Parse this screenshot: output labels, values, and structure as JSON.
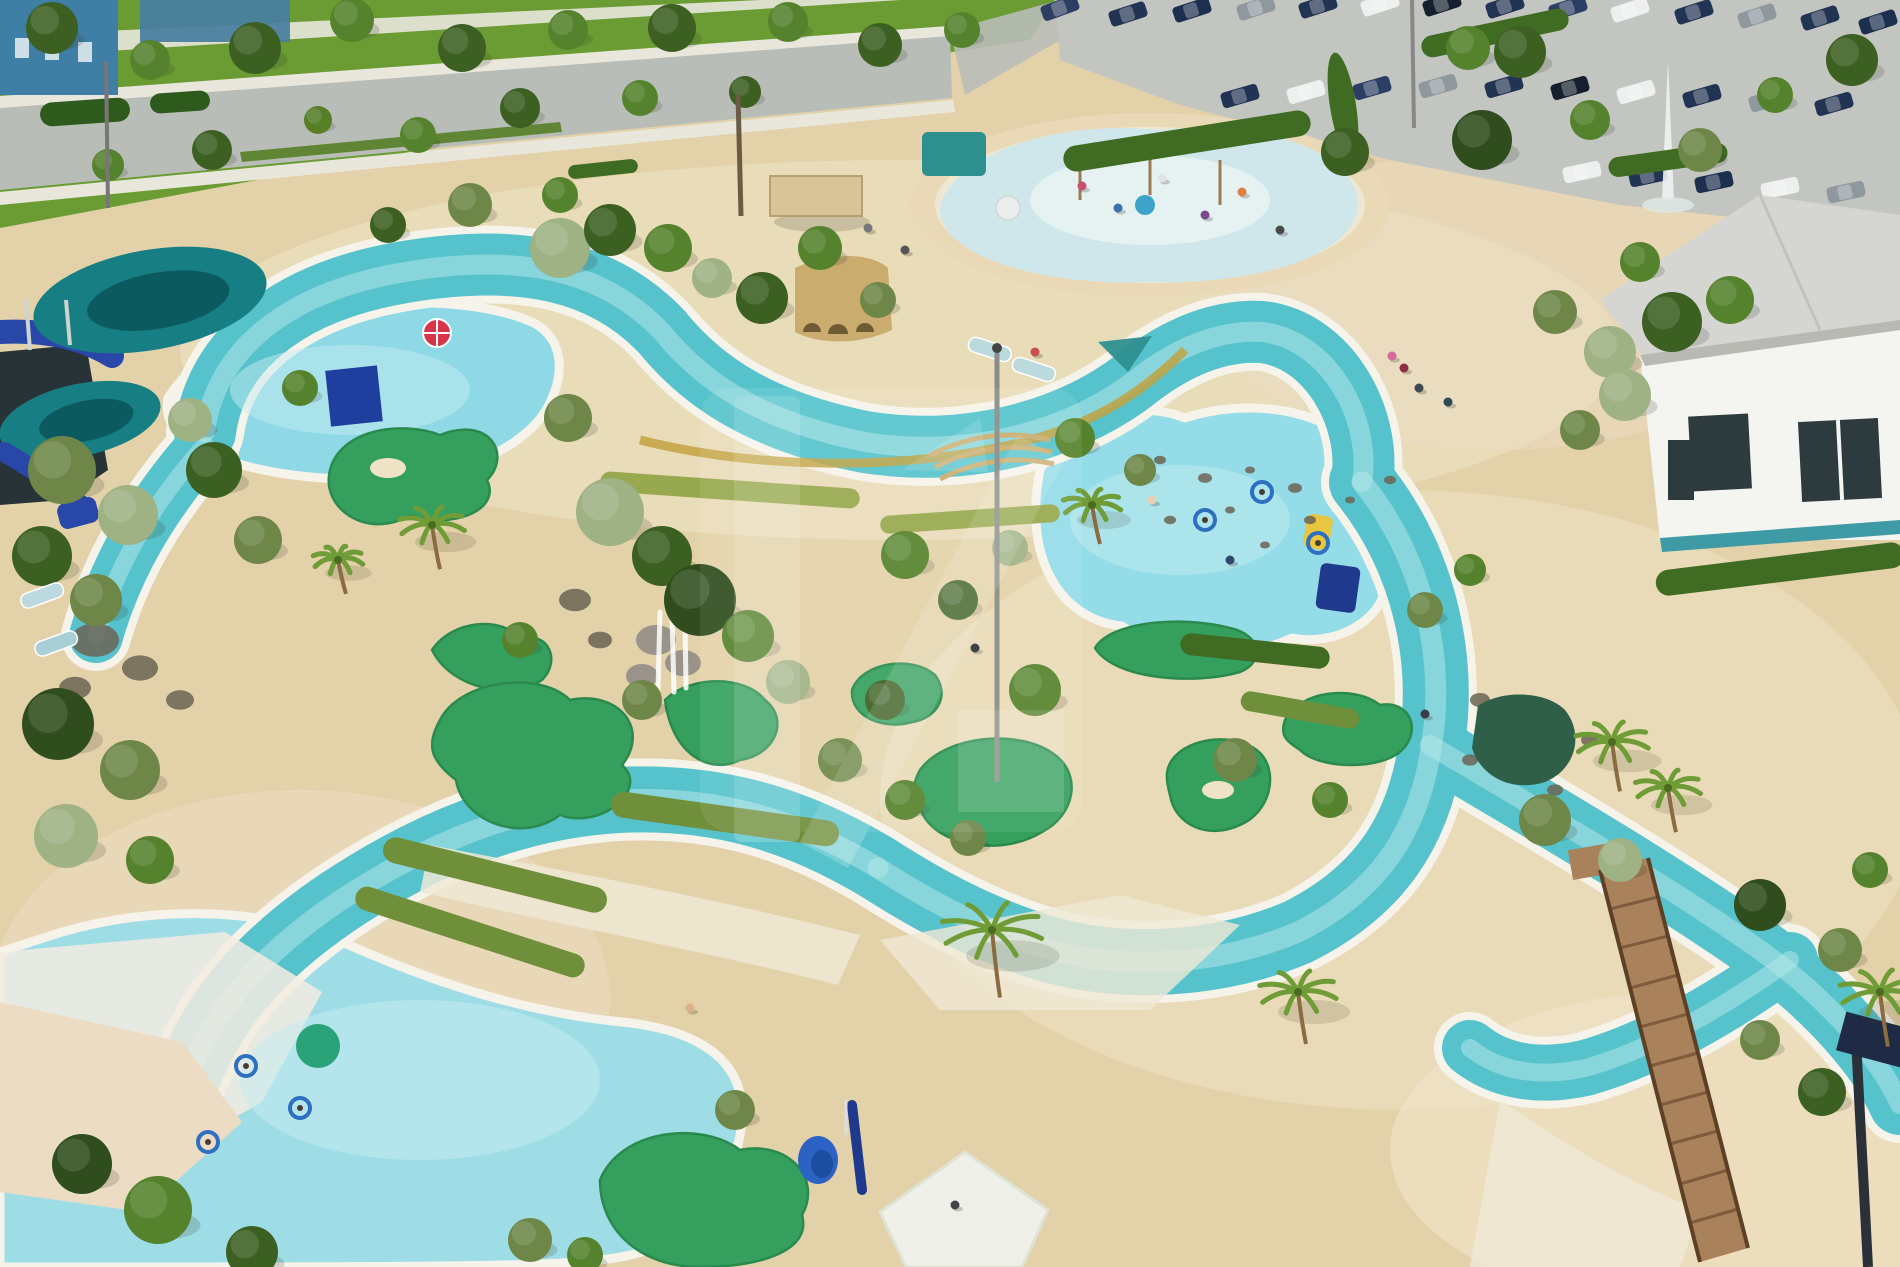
{
  "colors": {
    "sand_base": "#e3d2a9",
    "sand_light": "#efe3c6",
    "sand_pink": "#ecdcc3",
    "path_light": "#f0e9d6",
    "grass": "#6a9c33",
    "grass_dark": "#567f27",
    "road": "#b9bdb7",
    "sidewalk": "#e9e7dc",
    "parking": "#c2c5c0",
    "hedge": "#3f6b22",
    "building_blue": "#3f7fa6",
    "building_blue2": "#49809f",
    "building_white": "#f4f4f0",
    "roof_gray": "#d5d6d2",
    "window_dark": "#2e3b3e",
    "teal_trim": "#3e9aa4",
    "river": "#56c3cc",
    "river_rim": "#f6f3ea",
    "river_light": "#b9eaea",
    "pool_light": "#8fd9e6",
    "pool_pale": "#c6ebf0",
    "pool_big": "#9fdde6",
    "pool_right": "#93dce8",
    "golf_green": "#35a05e",
    "golf_edge": "#2a8a4e",
    "slide_teal": "#177e84",
    "slide_teal_dark": "#0b5a60",
    "slide_blue": "#2947a8",
    "structure_dark": "#1d2a30",
    "ruin_tan": "#c9ac6e",
    "ruin_arch": "#6e5a33",
    "gold": "#c2a23f",
    "wood": "#a9815a",
    "wood_dark": "#7d5b3c",
    "rail": "#5d4026",
    "pond_dark": "#2f5e49",
    "rock_gray": "#9a938a",
    "rock_dark": "#6b6454",
    "umbrella_red": "#d8344a",
    "chair_blue": "#2b62c4",
    "navy_mat": "#1f3a8c",
    "float_yellow": "#e8c63f",
    "lounger": "#bcd9dd",
    "tube_blue": "#2e6fc2",
    "canopy_teal": "#2e8f8f",
    "pergola": "#d8c497",
    "pergola_edge": "#b7a172",
    "fountain": "#eef2f2",
    "pole": "#8a8d86",
    "trunk": "#8a6b42",
    "frond": "#6f9c36",
    "splash_ring": "#ead9b6",
    "splash_mid": "#efe7d2",
    "splash_water": "#cfe7eb",
    "splash_inner": "#eaf3f3",
    "cube_blue": "#1f3f9e",
    "watermark": "#ffffff",
    "teal_circle": "#2aa37a",
    "beach_white": "#f3ece0"
  },
  "river": {
    "segments": [
      {
        "d": "M205,432 C215,352 285,292 405,272 C525,252 605,272 662,332 C705,385 765,422 865,442 C965,458 1065,432 1132,382 C1182,342 1225,330 1262,332 C1330,340 1372,420 1362,482",
        "w": 62
      },
      {
        "d": "M1362,482 C1425,560 1445,660 1432,742 C1420,832 1378,892 1298,932 C1218,966 1118,972 1038,946 C980,928 928,900 878,868",
        "w": 66
      },
      {
        "d": "M878,868 C798,820 718,795 618,800 C518,806 428,842 338,902 C258,956 212,1012 186,1082",
        "w": 66
      },
      {
        "d": "M205,445 C160,495 118,558 96,636",
        "w": 54
      },
      {
        "d": "M1430,745 C1540,810 1660,880 1760,950 C1830,1000 1880,1060 1900,1104",
        "w": 62
      },
      {
        "d": "M1790,960 C1720,1010 1650,1050 1585,1068 C1540,1078 1500,1072 1470,1048",
        "w": 56
      }
    ]
  },
  "pools": [
    {
      "d": "M168,398 C200,348 260,322 330,310 C400,298 480,300 532,322 C560,336 566,366 552,398 C540,430 500,458 448,470 C380,486 290,480 232,462 C190,448 162,430 168,398 Z",
      "fill": "#8fd9e6"
    },
    {
      "d": "M1040,470 C1065,418 1135,398 1185,418 C1245,398 1325,408 1355,448 C1398,470 1405,520 1385,558 C1400,610 1345,648 1292,638 C1242,662 1162,656 1122,626 C1062,620 1022,560 1040,470 Z",
      "fill": "#93dce8"
    },
    {
      "d": "M62,932 C152,906 262,906 342,942 C432,982 522,1012 622,1022 C702,1030 742,1062 742,1112 C742,1172 702,1222 642,1252 C592,1267 520,1267 0,1267 L0,952 Z",
      "fill": "#9fdde6"
    }
  ],
  "greens": [
    {
      "d": "M330,470 C340,430 400,420 440,435 C490,415 512,455 487,480 C502,510 452,530 410,515 C370,540 320,510 330,470 Z"
    },
    {
      "d": "M432,650 C452,620 502,615 522,640 C547,630 562,660 542,680 C512,700 452,690 432,650 Z"
    },
    {
      "d": "M440,720 C460,680 540,670 570,700 C620,690 650,730 622,765 C650,790 600,830 560,815 C520,845 462,820 456,780 C430,760 426,745 440,720 Z"
    },
    {
      "d": "M665,700 C690,675 745,675 765,700 C790,720 775,755 740,760 C710,775 672,755 665,700 Z"
    },
    {
      "d": "M852,690 C862,662 912,655 935,675 C950,695 938,718 912,722 C885,730 850,718 852,690 Z"
    },
    {
      "d": "M920,770 C945,735 1020,728 1055,755 C1082,775 1075,815 1042,832 C1005,855 945,848 925,818 C912,798 910,788 920,770 Z"
    },
    {
      "d": "M1095,648 C1110,622 1180,615 1230,628 C1262,635 1265,662 1240,672 C1195,685 1115,680 1095,648 Z"
    },
    {
      "d": "M1172,760 C1190,735 1242,732 1262,755 C1278,775 1270,812 1240,825 C1208,840 1175,825 1170,795 C1166,780 1165,770 1172,760 Z"
    },
    {
      "d": "M600,1180 C620,1130 700,1120 740,1150 C790,1140 822,1180 802,1215 C812,1250 762,1267 700,1267 C640,1267 600,1230 600,1180 Z"
    },
    {
      "d": "M1285,720 C1300,690 1355,685 1380,705 C1410,700 1422,730 1402,750 C1382,770 1320,770 1300,750 C1285,740 1280,735 1285,720 Z"
    }
  ],
  "trees": [
    [
      52,
      28,
      26,
      "#3c5f22"
    ],
    [
      150,
      60,
      20,
      "#55822c"
    ],
    [
      255,
      48,
      26,
      "#3c5f22"
    ],
    [
      352,
      20,
      22,
      "#55822c"
    ],
    [
      462,
      48,
      24,
      "#3c5f22"
    ],
    [
      568,
      30,
      20,
      "#55822c"
    ],
    [
      672,
      28,
      24,
      "#3c5f22"
    ],
    [
      788,
      22,
      20,
      "#55822c"
    ],
    [
      880,
      45,
      22,
      "#3c5f22"
    ],
    [
      962,
      30,
      18,
      "#55822c"
    ],
    [
      212,
      150,
      20,
      "#3c5f22"
    ],
    [
      418,
      135,
      18,
      "#55822c"
    ],
    [
      520,
      108,
      20,
      "#3c5f22"
    ],
    [
      640,
      98,
      18,
      "#55822c"
    ],
    [
      745,
      92,
      16,
      "#3c5f22"
    ],
    [
      108,
      165,
      16,
      "#55822c"
    ],
    [
      318,
      120,
      14,
      "#567f27"
    ],
    [
      470,
      205,
      22,
      "#6e8748"
    ],
    [
      560,
      195,
      18,
      "#55822c"
    ],
    [
      388,
      225,
      18,
      "#3c5f22"
    ],
    [
      560,
      248,
      30,
      "#9fb284"
    ],
    [
      610,
      230,
      26,
      "#3c5f22"
    ],
    [
      668,
      248,
      24,
      "#55822c"
    ],
    [
      712,
      278,
      20,
      "#9fb284"
    ],
    [
      762,
      298,
      26,
      "#3c5f22"
    ],
    [
      820,
      248,
      22,
      "#55822c"
    ],
    [
      878,
      300,
      18,
      "#6e8748"
    ],
    [
      568,
      418,
      24,
      "#6e8748"
    ],
    [
      610,
      512,
      34,
      "#9fb284"
    ],
    [
      662,
      556,
      30,
      "#3c5f22"
    ],
    [
      700,
      600,
      36,
      "#2f4d1d"
    ],
    [
      748,
      636,
      26,
      "#55822c"
    ],
    [
      788,
      682,
      22,
      "#9fb284"
    ],
    [
      642,
      700,
      20,
      "#6e8748"
    ],
    [
      520,
      640,
      18,
      "#55822c"
    ],
    [
      840,
      760,
      22,
      "#6e8748"
    ],
    [
      905,
      800,
      20,
      "#55822c"
    ],
    [
      968,
      838,
      18,
      "#6e8748"
    ],
    [
      62,
      470,
      34,
      "#6e8748"
    ],
    [
      128,
      515,
      30,
      "#9fb284"
    ],
    [
      42,
      556,
      30,
      "#3c5f22"
    ],
    [
      96,
      600,
      26,
      "#6e8748"
    ],
    [
      58,
      724,
      36,
      "#2f4d1d"
    ],
    [
      130,
      770,
      30,
      "#6e8748"
    ],
    [
      66,
      836,
      32,
      "#9fb284"
    ],
    [
      150,
      860,
      24,
      "#55822c"
    ],
    [
      214,
      470,
      28,
      "#3c5f22"
    ],
    [
      258,
      540,
      24,
      "#6e8748"
    ],
    [
      190,
      420,
      22,
      "#9fb284"
    ],
    [
      300,
      388,
      18,
      "#55822c"
    ],
    [
      1345,
      152,
      24,
      "#3c5f22"
    ],
    [
      1468,
      48,
      22,
      "#55822c"
    ],
    [
      1520,
      52,
      26,
      "#3c5f22"
    ],
    [
      1482,
      140,
      30,
      "#2f4d1d"
    ],
    [
      1590,
      120,
      20,
      "#55822c"
    ],
    [
      1700,
      150,
      22,
      "#6e8748"
    ],
    [
      1775,
      95,
      18,
      "#55822c"
    ],
    [
      1640,
      262,
      20,
      "#55822c"
    ],
    [
      1555,
      312,
      22,
      "#6e8748"
    ],
    [
      1610,
      352,
      26,
      "#9fb284"
    ],
    [
      1672,
      322,
      30,
      "#3c5f22"
    ],
    [
      1730,
      300,
      24,
      "#55822c"
    ],
    [
      1852,
      60,
      26,
      "#3c5f22"
    ],
    [
      1625,
      395,
      26,
      "#9fb284"
    ],
    [
      1580,
      430,
      20,
      "#6e8748"
    ],
    [
      1075,
      438,
      20,
      "#55822c"
    ],
    [
      1140,
      470,
      16,
      "#6e8748"
    ],
    [
      1010,
      548,
      18,
      "#9fb284"
    ],
    [
      1235,
      760,
      22,
      "#6e8748"
    ],
    [
      1330,
      800,
      18,
      "#55822c"
    ],
    [
      1545,
      820,
      26,
      "#6e8748"
    ],
    [
      1620,
      860,
      22,
      "#9fb284"
    ],
    [
      1760,
      905,
      26,
      "#2f4d1d"
    ],
    [
      1840,
      950,
      22,
      "#6e8748"
    ],
    [
      1870,
      870,
      18,
      "#55822c"
    ],
    [
      1760,
      1040,
      20,
      "#6e8748"
    ],
    [
      1822,
      1092,
      24,
      "#3c5f22"
    ],
    [
      82,
      1164,
      30,
      "#2f4d1d"
    ],
    [
      158,
      1210,
      34,
      "#55822c"
    ],
    [
      252,
      1252,
      26,
      "#3c5f22"
    ],
    [
      530,
      1240,
      22,
      "#6e8748"
    ],
    [
      585,
      1255,
      18,
      "#55822c"
    ],
    [
      735,
      1110,
      20,
      "#6e8748"
    ],
    [
      1425,
      610,
      18,
      "#6e8748"
    ],
    [
      1470,
      570,
      16,
      "#55822c"
    ],
    [
      905,
      555,
      24,
      "#55822c"
    ],
    [
      958,
      600,
      20,
      "#3c5f22"
    ],
    [
      1035,
      690,
      26,
      "#55822c"
    ],
    [
      885,
      700,
      20,
      "#3c5f22"
    ]
  ],
  "palms": [
    [
      432,
      525,
      34
    ],
    [
      1092,
      505,
      30
    ],
    [
      992,
      930,
      52
    ],
    [
      1298,
      992,
      40
    ],
    [
      1612,
      742,
      38
    ],
    [
      1668,
      788,
      34
    ],
    [
      1880,
      992,
      42
    ],
    [
      338,
      560,
      26
    ]
  ],
  "cars": [
    [
      1060,
      8,
      -20,
      "#2c3f63"
    ],
    [
      1128,
      14,
      -18,
      "#223453"
    ],
    [
      1192,
      10,
      -18,
      "#1c2f4e"
    ],
    [
      1256,
      8,
      -18,
      "#8f989e"
    ],
    [
      1318,
      6,
      -18,
      "#223453"
    ],
    [
      1380,
      4,
      -18,
      "#eef0ef"
    ],
    [
      1442,
      4,
      -18,
      "#15202e"
    ],
    [
      1505,
      6,
      -18,
      "#223453"
    ],
    [
      1568,
      8,
      -18,
      "#2c3f63"
    ],
    [
      1630,
      10,
      -18,
      "#eef0ef"
    ],
    [
      1694,
      12,
      -18,
      "#223453"
    ],
    [
      1757,
      16,
      -18,
      "#8f989e"
    ],
    [
      1820,
      18,
      -18,
      "#223453"
    ],
    [
      1878,
      22,
      -18,
      "#1c2f4e"
    ],
    [
      1240,
      96,
      -16,
      "#223453"
    ],
    [
      1306,
      92,
      -16,
      "#eef0ef"
    ],
    [
      1372,
      88,
      -16,
      "#2c3f63"
    ],
    [
      1438,
      86,
      -16,
      "#8f989e"
    ],
    [
      1504,
      86,
      -16,
      "#223453"
    ],
    [
      1570,
      88,
      -16,
      "#15202e"
    ],
    [
      1636,
      92,
      -16,
      "#eef0ef"
    ],
    [
      1702,
      96,
      -16,
      "#223453"
    ],
    [
      1768,
      100,
      -16,
      "#8f989e"
    ],
    [
      1834,
      104,
      -16,
      "#223453"
    ],
    [
      1582,
      172,
      -12,
      "#eef0ef"
    ],
    [
      1648,
      176,
      -12,
      "#223453"
    ],
    [
      1714,
      182,
      -12,
      "#1c2f4e"
    ],
    [
      1780,
      188,
      -12,
      "#eef0ef"
    ],
    [
      1846,
      192,
      -12,
      "#8f989e"
    ]
  ],
  "hedges": [
    [
      1062,
      128,
      250,
      26,
      -9,
      "#3f6b22"
    ],
    [
      1330,
      52,
      26,
      108,
      -9,
      "#3f6b22"
    ],
    [
      1420,
      22,
      150,
      22,
      -12,
      "#3f6b22"
    ],
    [
      1608,
      150,
      120,
      20,
      -8,
      "#3f6b22"
    ],
    [
      40,
      100,
      90,
      24,
      -4,
      "#2f5a1d"
    ],
    [
      150,
      92,
      60,
      20,
      -4,
      "#2f5a1d"
    ],
    [
      568,
      162,
      70,
      14,
      -6,
      "#3f6b22"
    ],
    [
      600,
      480,
      260,
      20,
      4,
      "#97a84e"
    ],
    [
      880,
      510,
      180,
      18,
      -4,
      "#97a84e"
    ],
    [
      380,
      862,
      230,
      26,
      14,
      "#6f8f3a"
    ],
    [
      610,
      806,
      230,
      26,
      8,
      "#6f8f3a"
    ],
    [
      350,
      920,
      240,
      24,
      18,
      "#6f8f3a"
    ],
    [
      1180,
      640,
      150,
      22,
      6,
      "#3f6b22"
    ],
    [
      1240,
      700,
      120,
      20,
      10,
      "#6f8f3a"
    ],
    [
      1655,
      556,
      250,
      26,
      -7,
      "#3f6b22"
    ]
  ],
  "people": [
    [
      1082,
      186,
      "#c94f6d"
    ],
    [
      1118,
      208,
      "#3a6fb0"
    ],
    [
      1162,
      178,
      "#e0e4e6"
    ],
    [
      1205,
      215,
      "#7a4a8c"
    ],
    [
      1242,
      192,
      "#d98243"
    ],
    [
      1280,
      230,
      "#4a4a4a"
    ],
    [
      1392,
      356,
      "#d868a0"
    ],
    [
      1404,
      368,
      "#8c2f45"
    ],
    [
      1419,
      388,
      "#404a52"
    ],
    [
      1448,
      402,
      "#2f4858"
    ],
    [
      1035,
      352,
      "#c94f4f"
    ],
    [
      1152,
      500,
      "#e8d0b0"
    ],
    [
      1230,
      560,
      "#30486e"
    ],
    [
      690,
      1008,
      "#e0b088"
    ],
    [
      955,
      1205,
      "#44444c"
    ],
    [
      1425,
      714,
      "#3c3c46"
    ],
    [
      975,
      648,
      "#2f2f38"
    ],
    [
      905,
      250,
      "#555555"
    ],
    [
      868,
      228,
      "#777777"
    ]
  ],
  "tubes": [
    [
      246,
      1066
    ],
    [
      300,
      1108
    ],
    [
      208,
      1142
    ],
    [
      1262,
      492
    ],
    [
      1318,
      543
    ],
    [
      1205,
      520
    ]
  ],
  "loungers": [
    [
      968,
      342,
      18,
      "#bcd9dd"
    ],
    [
      1012,
      362,
      18,
      "#bcd9dd"
    ],
    [
      20,
      588,
      -20,
      "#bcd9dd"
    ],
    [
      34,
      636,
      -20,
      "#a8ced6"
    ]
  ],
  "rocks": [
    [
      1160,
      460,
      6
    ],
    [
      1205,
      478,
      7
    ],
    [
      1250,
      470,
      5
    ],
    [
      1295,
      488,
      7
    ],
    [
      1230,
      510,
      5
    ],
    [
      1170,
      520,
      6
    ],
    [
      1310,
      520,
      6
    ],
    [
      1350,
      500,
      5
    ],
    [
      1390,
      480,
      6
    ],
    [
      1265,
      545,
      5
    ],
    [
      575,
      600,
      16
    ],
    [
      600,
      640,
      12
    ],
    [
      95,
      640,
      24
    ],
    [
      140,
      668,
      18
    ],
    [
      75,
      688,
      16
    ],
    [
      180,
      700,
      14
    ],
    [
      1480,
      700,
      10
    ],
    [
      1590,
      740,
      9
    ],
    [
      1555,
      790,
      8
    ],
    [
      1470,
      760,
      8
    ]
  ]
}
